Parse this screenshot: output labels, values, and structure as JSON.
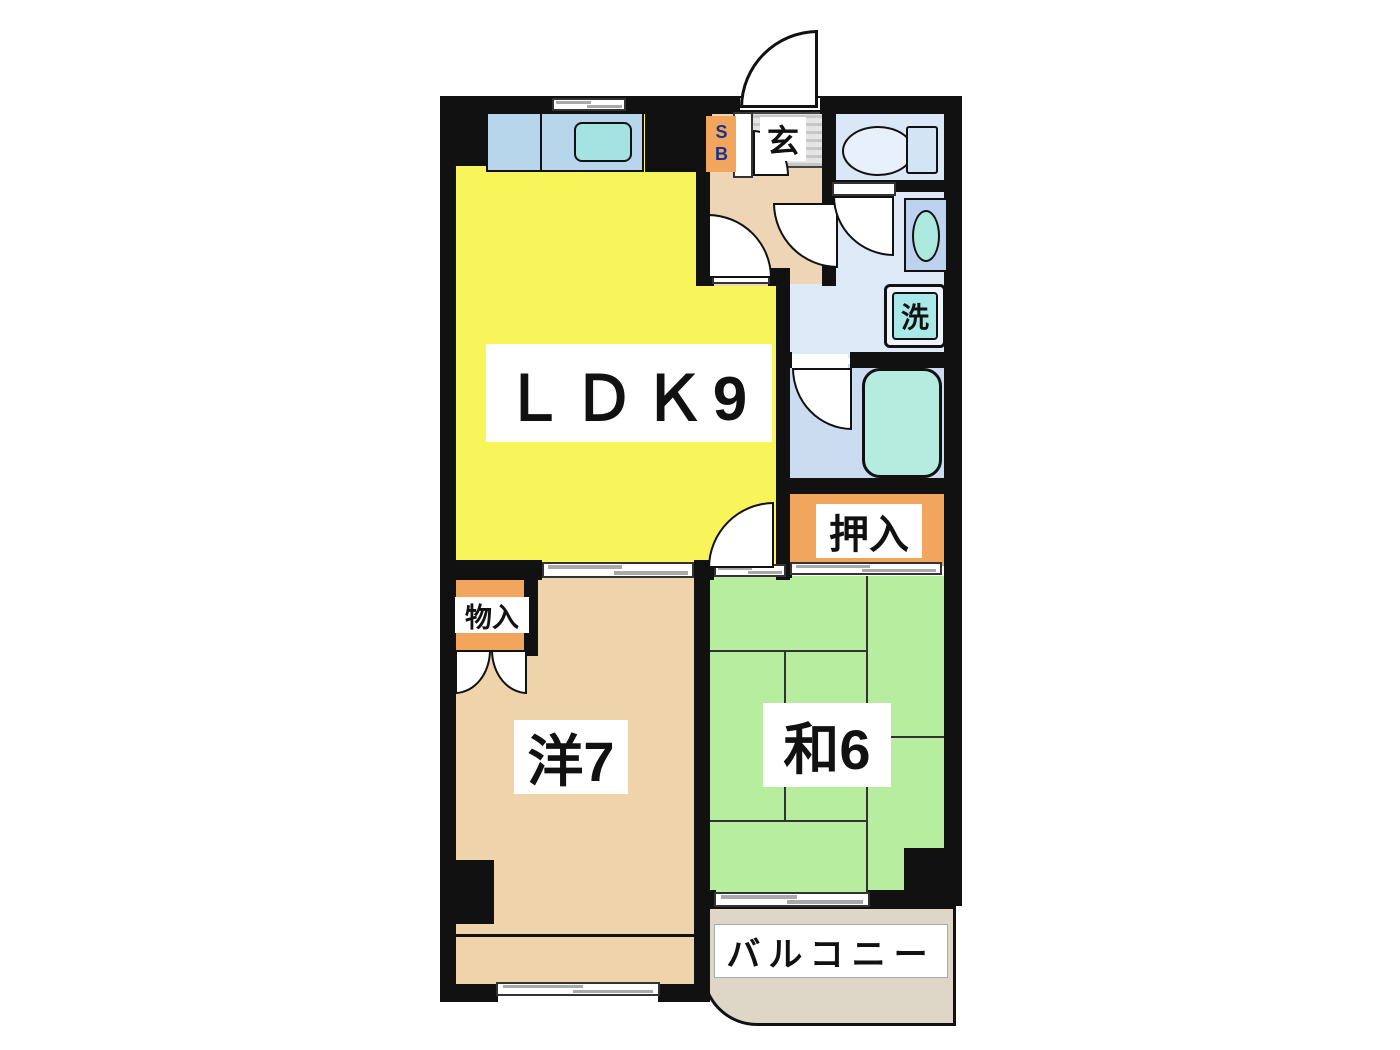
{
  "floorplan": {
    "title": "2LDK apartment floor plan",
    "rooms": {
      "ldk": {
        "label": "ＬＤＫ9"
      },
      "western_room": {
        "label": "洋7"
      },
      "japanese_room": {
        "label": "和6"
      },
      "closet_oshiire": {
        "label": "押入"
      },
      "closet_monoire": {
        "label": "物入"
      },
      "entrance_genkan": {
        "label": "玄"
      },
      "shoe_box": {
        "label": "SB"
      },
      "washing_machine": {
        "label": "洗"
      },
      "balcony": {
        "label": "バルコニー"
      }
    },
    "colors": {
      "wall": "#111111",
      "ldk_yellow": "#f7f559",
      "western_beige": "#efd4ab",
      "japanese_green": "#b6ed9e",
      "closet_orange": "#f2a55c",
      "hallway_tan": "#eed5b5",
      "toilet_blue": "#d9e7f6",
      "washroom_blue": "#dde9f7",
      "bathroom_blue": "#ccdcf0",
      "fixture_blue": "#b7d6ec",
      "water_cyan": "#aee8dd",
      "balcony_tan": "#ded7c8",
      "shoebox_text_blue": "#16338f"
    }
  }
}
